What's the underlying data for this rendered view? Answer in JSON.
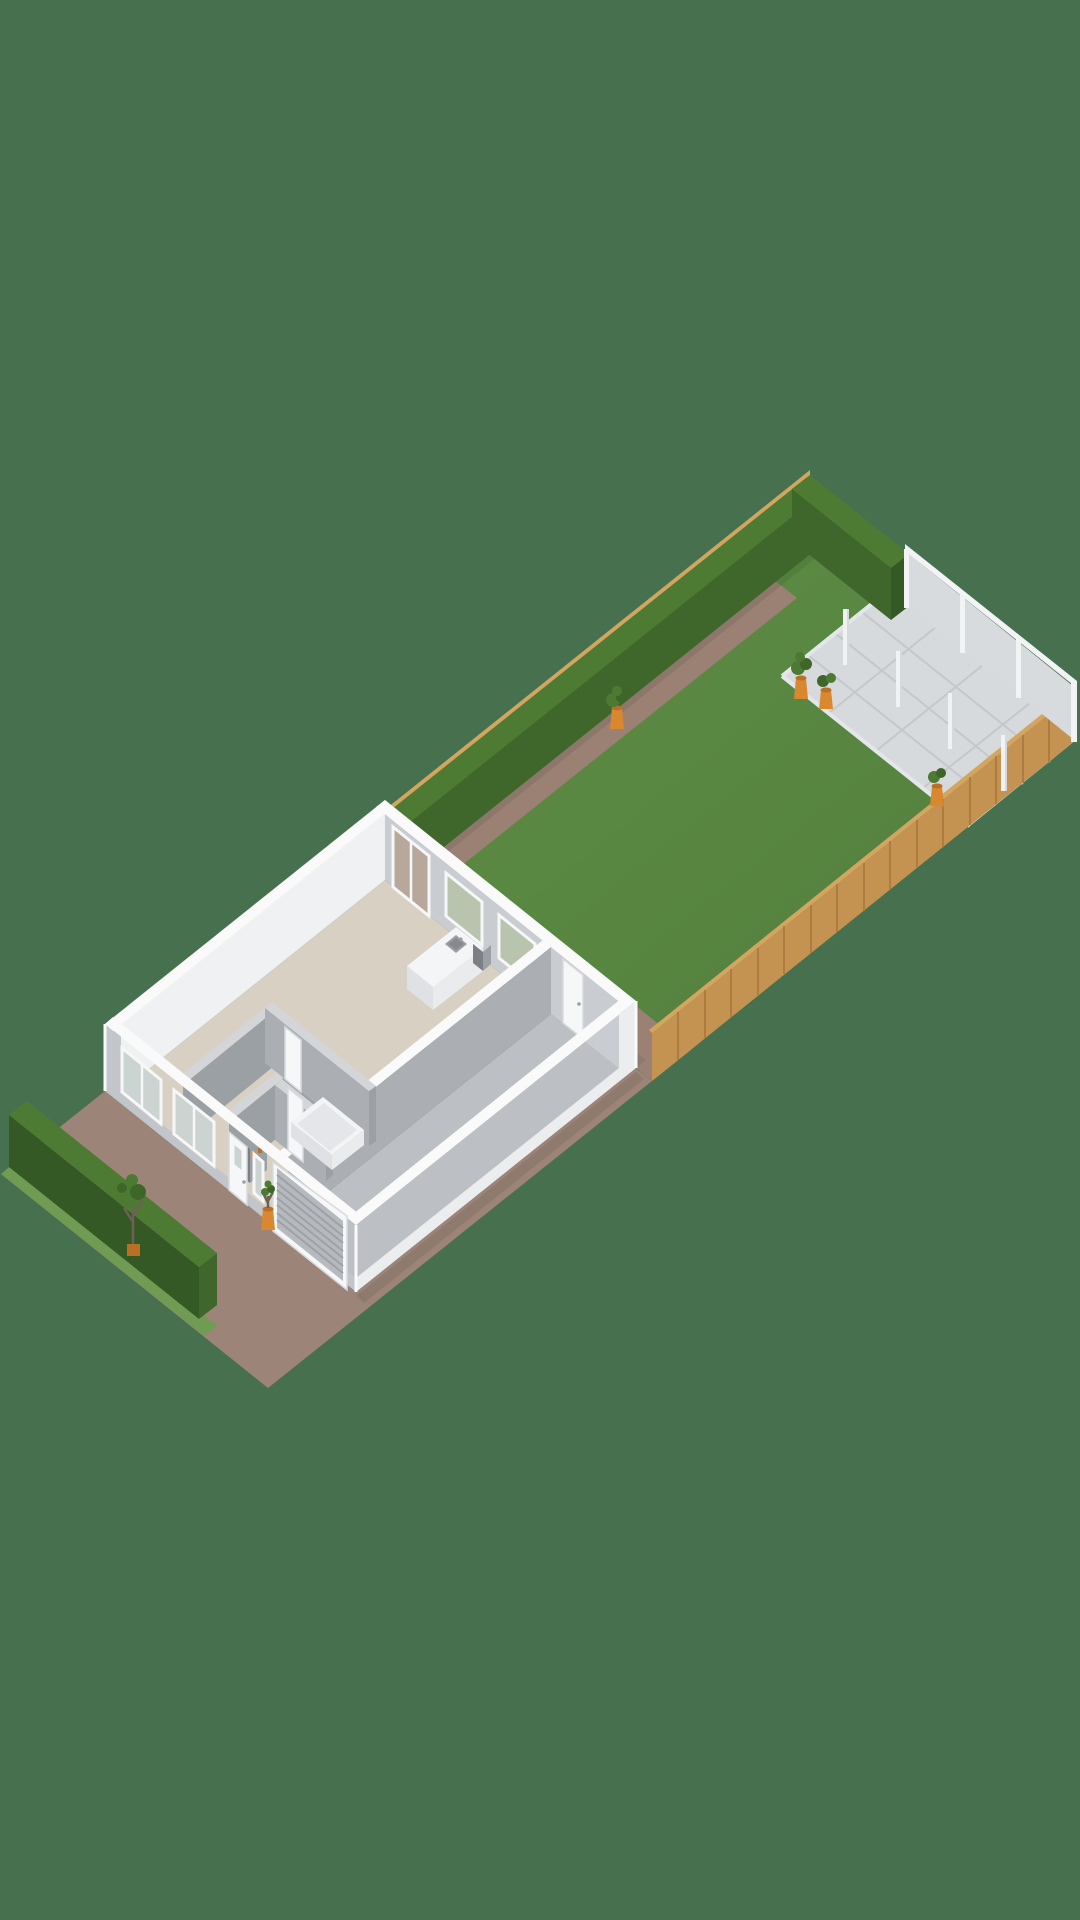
{
  "meta": {
    "title": "3D floorplan render - ground floor with garden",
    "view": "isometric",
    "canvas": {
      "width": 1080,
      "height": 1920
    },
    "visible_text": "none"
  },
  "scene": {
    "areas": [
      {
        "name": "driveway",
        "surface": "brown paving"
      },
      {
        "name": "front-grass-strip",
        "surface": "grass"
      },
      {
        "name": "front-hedge",
        "surface": "hedge"
      },
      {
        "name": "house",
        "rooms": [
          "living-room-with-kitchen",
          "bathroom",
          "hallway",
          "storage-room",
          "garage"
        ]
      },
      {
        "name": "back-garden",
        "surface": "lawn",
        "features": [
          "garden-path",
          "patio-tiles",
          "privacy-screens",
          "pergola-posts",
          "perimeter-hedge",
          "wooden-fence",
          "potted-plants"
        ]
      }
    ],
    "objects": [
      "kitchen-island-with-sink",
      "bathtub",
      "storage-shelf",
      "front-door",
      "garage-roller-door",
      "patio-doors",
      "rear-garage-door",
      "windows",
      "potted-plant-front-door",
      "driveway-tree",
      "garden-pot-on-path",
      "garden-pot-pair",
      "garden-pot-near-fence",
      "white-posts",
      "privacy-screen-panels"
    ]
  },
  "colors": {
    "bg": "#47704F",
    "driveway": "#9C8578",
    "path": "#9A8174",
    "lawn_front": "#6F9B52",
    "lawn_a": "#5E8E46",
    "lawn_b": "#527F3C",
    "hedge_top": "#4E7B33",
    "hedge_face": "#3F672B",
    "hedge_dark": "#355924",
    "wood": "#C49352",
    "wood_cap": "#D3A55F",
    "wood_dark": "#AE7C3E",
    "wall_top": "#FAFAFB",
    "facade_gray": "#C2C5C9",
    "facade_light": "#ECEDEF",
    "inner_bright": "#F0F1F3",
    "inner_face": "#C9CCD0",
    "partition_top": "#D3D5D8",
    "partition_face": "#ABAFB4",
    "partition_dark": "#9BA0A5",
    "floor": "#D8D1C3",
    "garage_floor": "#BCBFC3",
    "patio": "#D7DADD",
    "patio_line": "#C4C7CB",
    "patio_edge": "#E4E7E9",
    "glass": "#CCD4D2",
    "glass_garden": "#B8C4AE",
    "glass_path": "#B7A89B",
    "frame": "#F6F7F8",
    "door_edge": "#D8DADD",
    "roller": "#B6B9BD",
    "roller_line": "#9EA2A6",
    "pot": "#D9882F",
    "pot_dark": "#B96F24",
    "plant": "#4C7A33",
    "plant_dark": "#3E6629",
    "post": "#F1F2F4",
    "post_shade": "#D6D9DC",
    "screen_panel": "#D8DBDE",
    "screen_frame": "#F2F3F5",
    "tub": "#F3F4F6",
    "tub_inner": "#E4E6E9",
    "island_top": "#F4F5F7",
    "island_face": "#DFE1E4",
    "island_side": "#E9EBED",
    "sink": "#9A9EA3",
    "sink_inner": "#85898E",
    "trunk": "#6E6154",
    "dark_item": "#7C8085"
  }
}
